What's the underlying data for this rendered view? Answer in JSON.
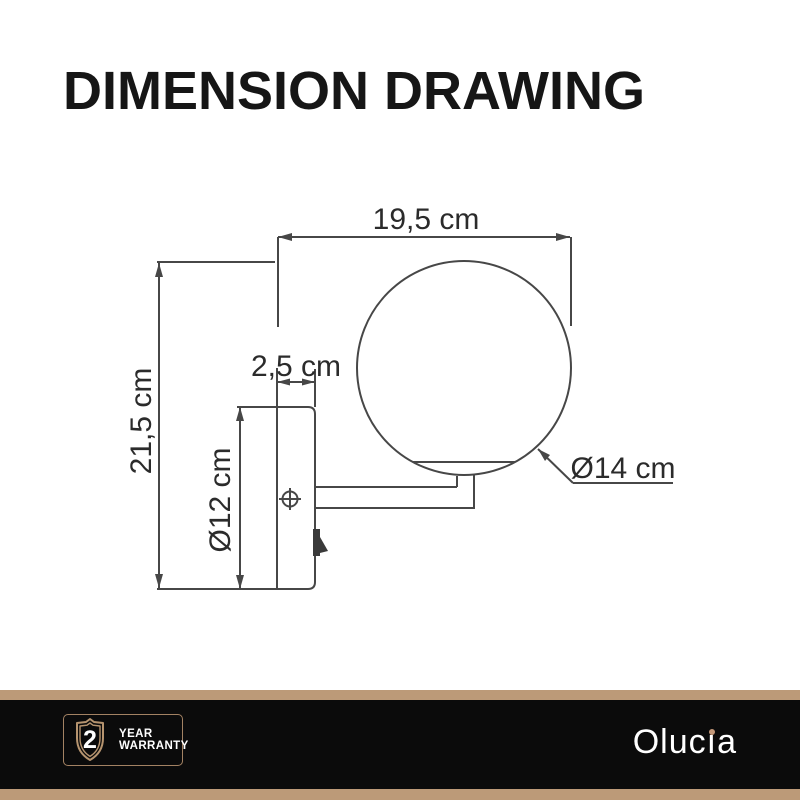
{
  "page": {
    "title": "DIMENSION DRAWING"
  },
  "drawing": {
    "object": "wall lamp with globe shade, side view",
    "dimensions": {
      "total_width": "19,5 cm",
      "total_height": "21,5 cm",
      "plate_depth": "2,5 cm",
      "plate_height": "Ø12 cm",
      "globe_diameter": "Ø14 cm"
    }
  },
  "footer": {
    "warranty": {
      "years": "2",
      "line1": "YEAR",
      "line2": "WARRANTY"
    },
    "brand": {
      "name": "Olucia",
      "prefix": "Oluc",
      "i_stem": "ı",
      "suffix": "a"
    },
    "colors": {
      "accent_tan": "#bc9a78",
      "badge_border": "#a38263",
      "background_black": "#0b0b0b"
    }
  }
}
